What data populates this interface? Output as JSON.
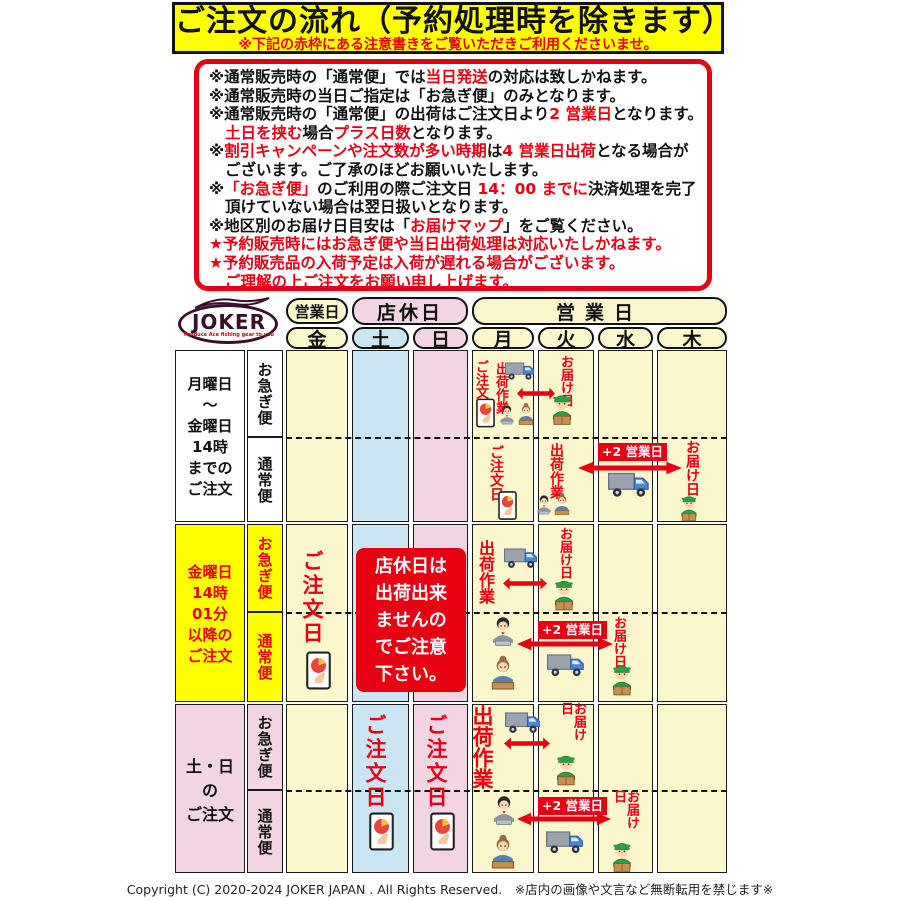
{
  "title": {
    "main": "ご注文の流れ（予約処理時を除きます）",
    "sub": "※下記の赤枠にある注意書きをご覧いただきご利用くださいませ。"
  },
  "notice": {
    "lines": [
      {
        "indent": false,
        "segs": [
          {
            "t": "※通常販売時の「通常便」では"
          },
          {
            "t": "当日発送",
            "red": true
          },
          {
            "t": "の対応は致しかねます。"
          }
        ]
      },
      {
        "indent": false,
        "segs": [
          {
            "t": "※通常販売時の当日ご指定は「お急ぎ便」のみとなります。"
          }
        ]
      },
      {
        "indent": false,
        "segs": [
          {
            "t": "※通常販売時の「通常便」の出荷はご注文日より"
          },
          {
            "t": "2 営業日",
            "red": true
          },
          {
            "t": "となります。"
          }
        ]
      },
      {
        "indent": true,
        "segs": [
          {
            "t": "土日を挟む",
            "red": true
          },
          {
            "t": "場合"
          },
          {
            "t": "プラス日数",
            "red": true
          },
          {
            "t": "となります。"
          }
        ]
      },
      {
        "indent": false,
        "segs": [
          {
            "t": "※"
          },
          {
            "t": "割引キャンペーンや注文数が多い時期",
            "red": true
          },
          {
            "t": "は"
          },
          {
            "t": "4 営業日出荷",
            "red": true
          },
          {
            "t": "となる場合が"
          }
        ]
      },
      {
        "indent": true,
        "segs": [
          {
            "t": "ございます。ご了承のほどお願いいたします。"
          }
        ]
      },
      {
        "indent": false,
        "segs": [
          {
            "t": "※"
          },
          {
            "t": "「お急ぎ便」",
            "red": true
          },
          {
            "t": "のご利用の際ご注文日 "
          },
          {
            "t": "14：00 までに",
            "red": true
          },
          {
            "t": "決済処理を完了"
          }
        ]
      },
      {
        "indent": true,
        "segs": [
          {
            "t": "頂けていない場合は翌日扱いとなります。"
          }
        ]
      },
      {
        "indent": false,
        "segs": [
          {
            "t": "※地区別のお届け日目安は「"
          },
          {
            "t": "お届けマップ",
            "red": true
          },
          {
            "t": "」をご覧ください。"
          }
        ]
      },
      {
        "indent": false,
        "segs": [
          {
            "t": "★予約販売時にはお急ぎ便や当日出荷処理は対応いたしかねます。",
            "red": true
          }
        ]
      },
      {
        "indent": false,
        "segs": [
          {
            "t": "★予約販売品の入荷予定は入荷が遅れる場合がございます。",
            "red": true
          }
        ]
      },
      {
        "indent": true,
        "segs": [
          {
            "t": "ご理解の上ご注文をお願い申し上げます。",
            "red": true
          }
        ]
      }
    ]
  },
  "logo": {
    "name": "JOKER",
    "tagline": "Produce Ace fishing gear to you"
  },
  "header": {
    "group_business": "営業日",
    "group_holiday": "店休日",
    "group_business2": "営業日",
    "days": [
      "金",
      "土",
      "日",
      "月",
      "火",
      "水",
      "木"
    ]
  },
  "rows": [
    {
      "label": "月曜日\n〜\n金曜日\n14時\nまでの\nご注文",
      "express": "お急ぎ便",
      "normal": "通常便"
    },
    {
      "label": "金曜日\n14時\n01分\n以降の\nご注文",
      "express": "お急ぎ便",
      "normal": "通常便"
    },
    {
      "label": "土・日\nの\nご注文",
      "express": "お急ぎ便",
      "normal": "通常便"
    }
  ],
  "labels": {
    "order_day": "ご注文日",
    "shipping_work": "出荷作業",
    "delivery_day": "お届け日",
    "plus_2_business_days": "+2 営業日",
    "closed_notice": "店休日は\n出荷出来\nませんの\nでご注意\n下さい。"
  },
  "colors": {
    "accent_red": "#E60012",
    "banner_yellow": "#FFFF00",
    "business_day": "#FAF7CD",
    "saturday_blue": "#C9E6F2",
    "sunday_pink": "#F2D5E2"
  },
  "footer": {
    "copyright": "Copyright (C) 2020-2024 JOKER JAPAN . All Rights Reserved.　※店内の画像や文言など無断転用を禁じます※"
  }
}
